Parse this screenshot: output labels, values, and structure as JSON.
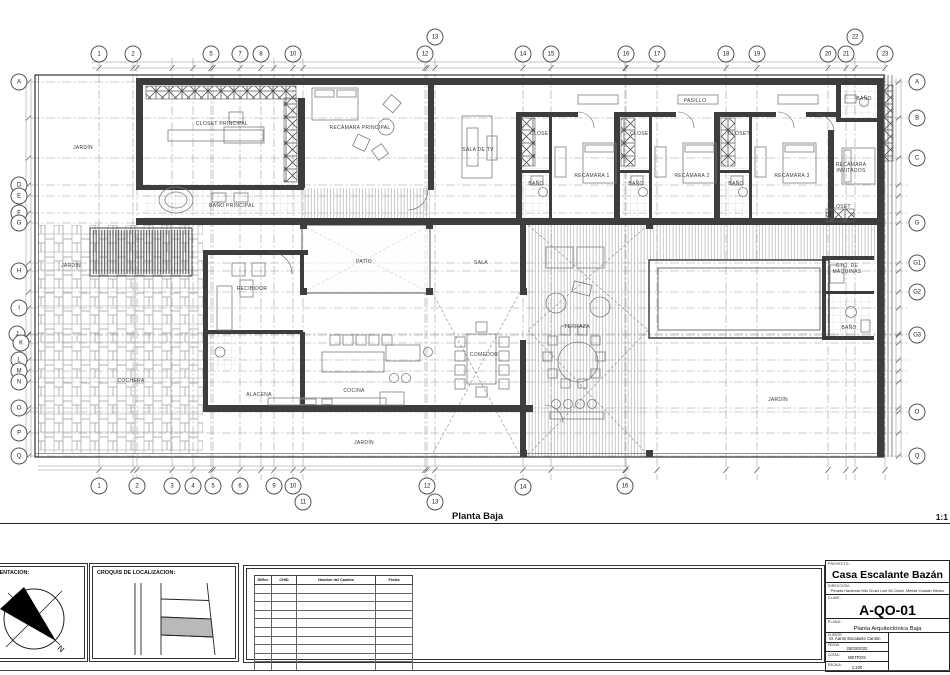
{
  "sheet": {
    "plan_caption": "Planta Baja",
    "scale_note": "1:1"
  },
  "grid": {
    "top": [
      {
        "label": "1",
        "x": 99,
        "y": 54
      },
      {
        "label": "2",
        "x": 133,
        "y": 54
      },
      {
        "label": "5",
        "x": 211,
        "y": 54
      },
      {
        "label": "7",
        "x": 240,
        "y": 54
      },
      {
        "label": "8",
        "x": 261,
        "y": 54
      },
      {
        "label": "10",
        "x": 293,
        "y": 54
      },
      {
        "label": "12",
        "x": 425,
        "y": 54
      },
      {
        "label": "13",
        "x": 435,
        "y": 37
      },
      {
        "label": "14",
        "x": 523,
        "y": 54
      },
      {
        "label": "15",
        "x": 551,
        "y": 54
      },
      {
        "label": "16",
        "x": 626,
        "y": 54
      },
      {
        "label": "17",
        "x": 657,
        "y": 54
      },
      {
        "label": "18",
        "x": 726,
        "y": 54
      },
      {
        "label": "19",
        "x": 757,
        "y": 54
      },
      {
        "label": "20",
        "x": 828,
        "y": 54
      },
      {
        "label": "21",
        "x": 846,
        "y": 54
      },
      {
        "label": "22",
        "x": 855,
        "y": 37
      },
      {
        "label": "23",
        "x": 885,
        "y": 54
      }
    ],
    "bottom": [
      {
        "label": "1",
        "x": 99,
        "y": 486
      },
      {
        "label": "2",
        "x": 137,
        "y": 486
      },
      {
        "label": "3",
        "x": 172,
        "y": 486
      },
      {
        "label": "4",
        "x": 193,
        "y": 486
      },
      {
        "label": "5",
        "x": 213,
        "y": 486
      },
      {
        "label": "6",
        "x": 240,
        "y": 486
      },
      {
        "label": "9",
        "x": 274,
        "y": 486
      },
      {
        "label": "10",
        "x": 293,
        "y": 486
      },
      {
        "label": "11",
        "x": 303,
        "y": 502
      },
      {
        "label": "12",
        "x": 427,
        "y": 486
      },
      {
        "label": "13",
        "x": 435,
        "y": 502
      },
      {
        "label": "14",
        "x": 523,
        "y": 487
      },
      {
        "label": "16",
        "x": 625,
        "y": 486
      }
    ],
    "left": [
      {
        "label": "A",
        "x": 19,
        "y": 82
      },
      {
        "label": "D",
        "x": 19,
        "y": 185
      },
      {
        "label": "E",
        "x": 19,
        "y": 196
      },
      {
        "label": "F",
        "x": 19,
        "y": 213
      },
      {
        "label": "G",
        "x": 19,
        "y": 223
      },
      {
        "label": "H",
        "x": 19,
        "y": 271
      },
      {
        "label": "I",
        "x": 19,
        "y": 308
      },
      {
        "label": "J",
        "x": 17,
        "y": 334
      },
      {
        "label": "K",
        "x": 21,
        "y": 343
      },
      {
        "label": "L",
        "x": 19,
        "y": 360
      },
      {
        "label": "M",
        "x": 19,
        "y": 371
      },
      {
        "label": "N",
        "x": 19,
        "y": 382
      },
      {
        "label": "O",
        "x": 19,
        "y": 408
      },
      {
        "label": "P",
        "x": 19,
        "y": 433
      },
      {
        "label": "Q",
        "x": 19,
        "y": 456
      }
    ],
    "right": [
      {
        "label": "A",
        "x": 917,
        "y": 82
      },
      {
        "label": "B",
        "x": 917,
        "y": 118
      },
      {
        "label": "C",
        "x": 917,
        "y": 158
      },
      {
        "label": "G",
        "x": 917,
        "y": 223
      },
      {
        "label": "G1",
        "x": 917,
        "y": 263
      },
      {
        "label": "G2",
        "x": 917,
        "y": 292
      },
      {
        "label": "G3",
        "x": 917,
        "y": 335
      },
      {
        "label": "O",
        "x": 917,
        "y": 412
      },
      {
        "label": "Q",
        "x": 917,
        "y": 456
      }
    ]
  },
  "rooms": [
    {
      "label": "JARDÍN",
      "x": 83,
      "y": 148
    },
    {
      "label": "CLOSET PRINCIPAL",
      "x": 222,
      "y": 124
    },
    {
      "label": "BAÑO PRINCIPAL",
      "x": 232,
      "y": 206
    },
    {
      "label": "RECÁMARA PRINCIPAL",
      "x": 360,
      "y": 128
    },
    {
      "label": "SALA DE TV",
      "x": 478,
      "y": 150
    },
    {
      "label": "PASILLO",
      "x": 695,
      "y": 101
    },
    {
      "label": "CLOSET",
      "x": 541,
      "y": 134
    },
    {
      "label": "BAÑO",
      "x": 536,
      "y": 184
    },
    {
      "label": "RECÁMARA 1",
      "x": 592,
      "y": 176
    },
    {
      "label": "CLOSET",
      "x": 641,
      "y": 134
    },
    {
      "label": "BAÑO",
      "x": 636,
      "y": 184
    },
    {
      "label": "RECÁMARA 2",
      "x": 692,
      "y": 176
    },
    {
      "label": "CLOSET",
      "x": 739,
      "y": 134
    },
    {
      "label": "BAÑO",
      "x": 736,
      "y": 184
    },
    {
      "label": "RECÁMARA 3",
      "x": 792,
      "y": 176
    },
    {
      "label": "BAÑO",
      "x": 864,
      "y": 99
    },
    {
      "label": "RECÁMARA\nINVITADOS",
      "x": 851,
      "y": 168
    },
    {
      "label": "CLOSET",
      "x": 840,
      "y": 207
    },
    {
      "label": "JARDÍN",
      "x": 71,
      "y": 266
    },
    {
      "label": "RECIBIDOR",
      "x": 252,
      "y": 289
    },
    {
      "label": "PATIO",
      "x": 364,
      "y": 262
    },
    {
      "label": "SALA",
      "x": 481,
      "y": 263
    },
    {
      "label": "TERRAZA",
      "x": 577,
      "y": 327
    },
    {
      "label": "COMEDOR",
      "x": 484,
      "y": 355
    },
    {
      "label": "COCINA",
      "x": 354,
      "y": 391
    },
    {
      "label": "ALACENA",
      "x": 259,
      "y": 395
    },
    {
      "label": "COCHERA",
      "x": 131,
      "y": 381
    },
    {
      "label": "JARDÍN",
      "x": 364,
      "y": 443
    },
    {
      "label": "JARDÍN",
      "x": 778,
      "y": 400
    },
    {
      "label": "CTO. DE\nMÁQUINAS",
      "x": 847,
      "y": 269
    },
    {
      "label": "BAÑO",
      "x": 849,
      "y": 328
    }
  ],
  "orientation": {
    "label": "ORIENTACION:",
    "north": "N"
  },
  "croquis": {
    "label": "CROQUIS DE LOCALIZACION:"
  },
  "revisions": {
    "headers": [
      "IDRev",
      "CHID",
      "Nombre del Cambio",
      "Fecha"
    ],
    "empty_rows": 10
  },
  "titleblock": {
    "proyecto_label": "PROYECTO:",
    "proyecto": "Casa Escalante Bazán",
    "direccion_label": "DIRECCION:",
    "direccion": "Privada Hacienda Villa Chulul Lote 56 Chulul, Mérida Yucatán México",
    "clave_label": "CLAVE:",
    "clave": "A-QO-01",
    "plano_label": "PLANO:",
    "plano": "Planta Arquitectónica Baja",
    "cliente_label": "CLIENTE:",
    "cliente": "Sr. Aaron Escalante Cantón",
    "fecha_label": "FECHA:",
    "fecha": "25/03/2022",
    "cotas_label": "COTAS:",
    "cotas": "METROS",
    "escala_label": "ESCALA:",
    "escala": "1:100"
  }
}
